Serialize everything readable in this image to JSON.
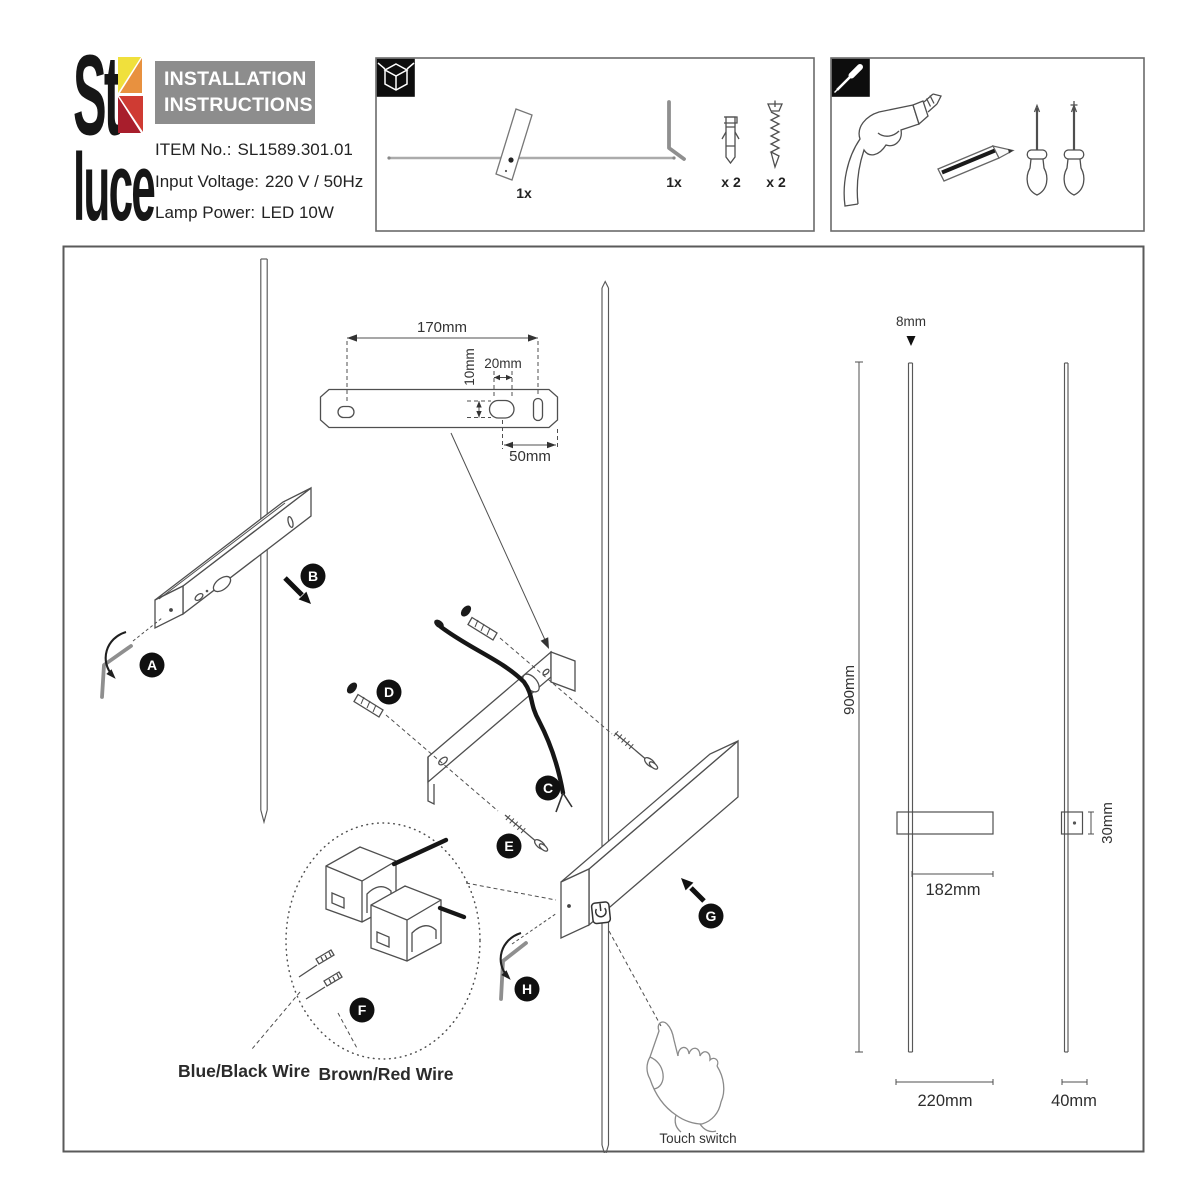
{
  "brand": {
    "logo_line1": "St",
    "logo_line2": "luce"
  },
  "header": {
    "title_line1": "INSTALLATION",
    "title_line2": "INSTRUCTIONS",
    "item_no_label": "ITEM No.:",
    "item_no_value": "SL1589.301.01",
    "voltage_label": "Input Voltage:",
    "voltage_value": "220 V / 50Hz",
    "power_label": "Lamp Power:",
    "power_value": "LED 10W"
  },
  "package_box": {
    "icon": "package-cube-icon",
    "items": [
      {
        "name": "wall lamp",
        "qty": "1x"
      },
      {
        "name": "hex key",
        "qty": "1x"
      },
      {
        "name": "wall plug",
        "qty": "x 2"
      },
      {
        "name": "screw",
        "qty": "x 2"
      }
    ]
  },
  "tools_box": {
    "icon": "screwdriver-icon",
    "tools": [
      "electric drill",
      "pencil",
      "flat screwdriver",
      "phillips screwdriver"
    ]
  },
  "diagram": {
    "step_labels": [
      "A",
      "B",
      "C",
      "D",
      "E",
      "F",
      "G",
      "H"
    ],
    "bracket_dims": {
      "length": "170mm",
      "hole_height": "10mm",
      "hole_width": "20mm",
      "end_offset": "50mm"
    },
    "product_dims": {
      "rod_diameter": "8mm",
      "rod_length": "900mm",
      "body_offset": "182mm",
      "body_height": "30mm",
      "body_length": "220mm",
      "body_depth": "40mm"
    },
    "wire_labels": {
      "blue_black": "Blue/Black Wire",
      "brown_red": "Brown/Red Wire"
    },
    "touch_switch_label": "Touch switch"
  },
  "colors": {
    "line": "#4f4f4f",
    "text": "#2e2e2e",
    "badge": "#101010",
    "header_bg": "#8d8d8d",
    "header_text": "#ffffff",
    "logo_yellow": "#f0e03c",
    "logo_orange": "#e8913f",
    "logo_red": "#cf3b33",
    "logo_dark_red": "#a81e2c"
  }
}
